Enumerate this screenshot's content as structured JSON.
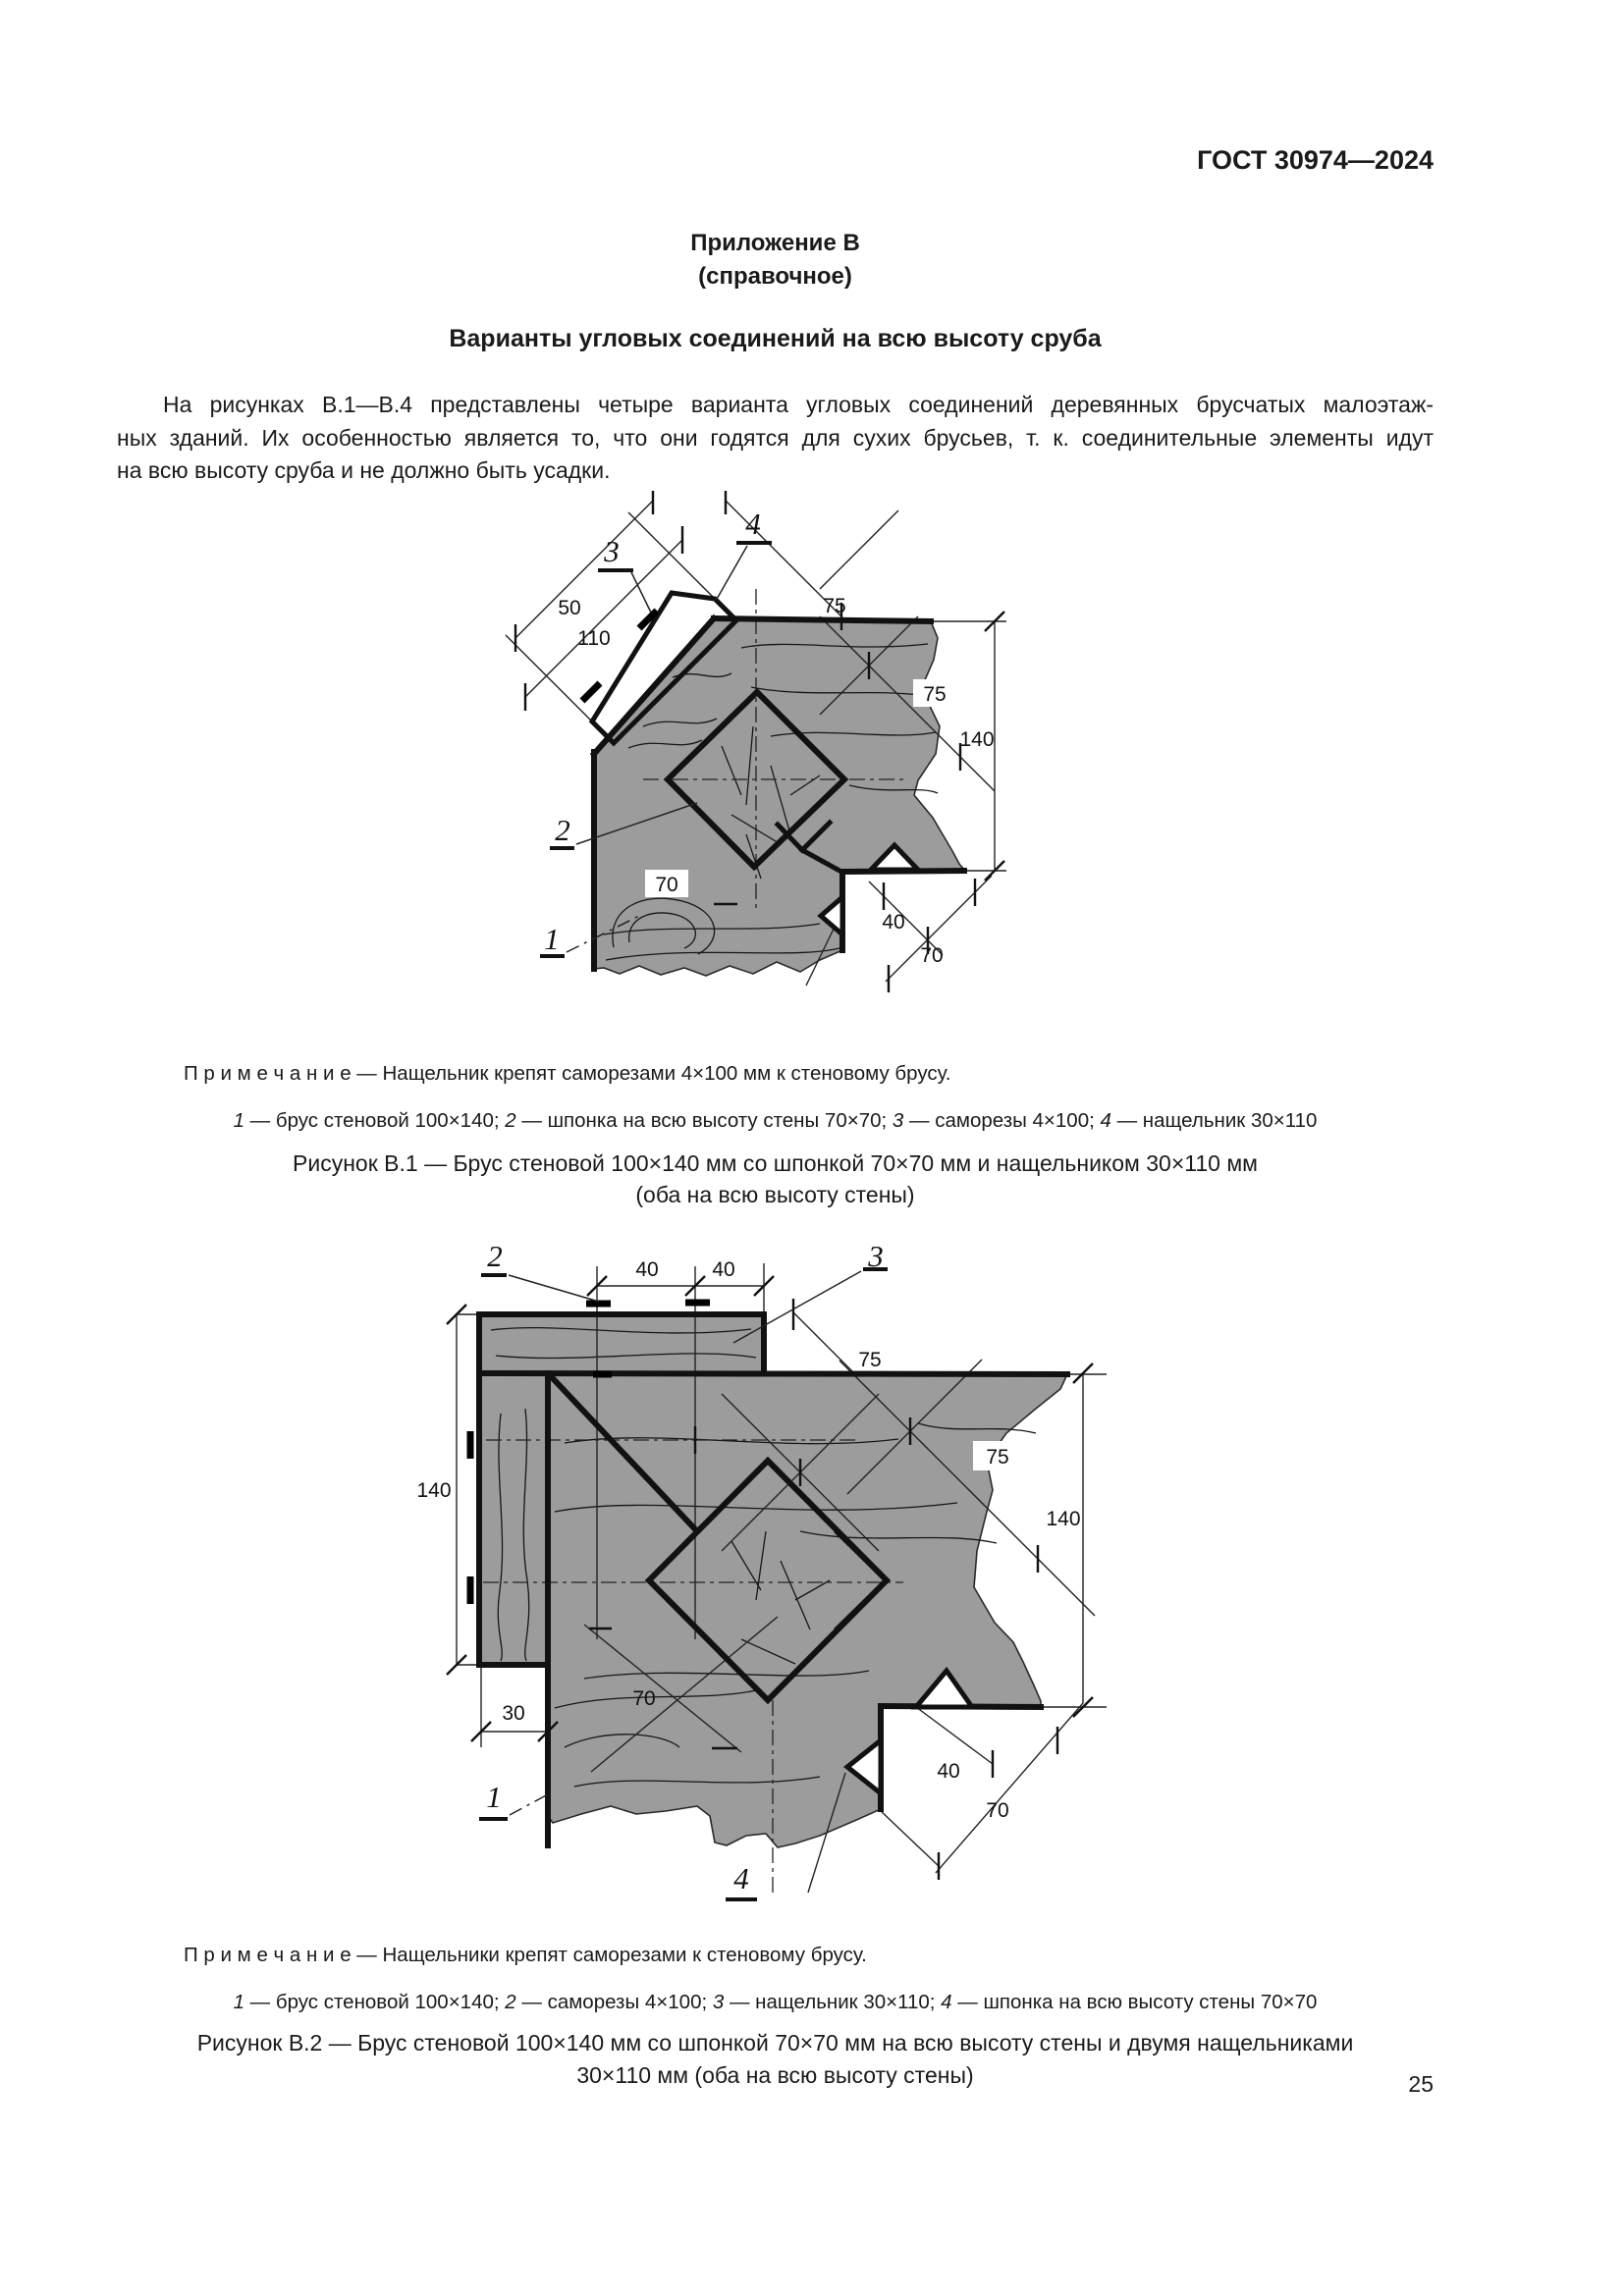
{
  "page": {
    "header": "ГОСТ 30974—2024",
    "number": "25"
  },
  "appendix": {
    "title": "Приложение В",
    "subtitle": "(справочное)",
    "heading": "Варианты угловых соединений на всю высоту сруба"
  },
  "intro": {
    "lines": [
      "На рисунках В.1—В.4 представлены четыре варианта угловых соединений деревянных брусчатых малоэтаж-",
      "ных зданий. Их особенностью является то, что они годятся для сухих брусьев, т. к. соединительные элементы идут",
      "на всю высоту сруба и не должно быть усадки."
    ]
  },
  "fig1": {
    "note": "П р и м е ч а н и е — Нащельник крепят саморезами 4×100 мм к стеновому брусу.",
    "legend": [
      {
        "num": "1",
        "text": " — брус стеновой 100×140; "
      },
      {
        "num": "2",
        "text": " — шпонка на всю высоту стены 70×70; "
      },
      {
        "num": "3",
        "text": " — саморезы 4×100; "
      },
      {
        "num": "4",
        "text": " — нащельник 30×110"
      }
    ],
    "caption_line1": "Рисунок В.1 — Брус стеновой 100×140 мм со шпонкой 70×70 мм и нащельником 30×110 мм",
    "caption_line2": "(оба на всю высоту стены)",
    "parts": {
      "p1": "1",
      "p2": "2",
      "p3": "3",
      "p4": "4"
    },
    "dims": {
      "d50": "50",
      "d110": "110",
      "d75_top": "75",
      "d75_right": "75",
      "d140": "140",
      "d70_key": "70",
      "d40": "40",
      "d70_corner": "70"
    }
  },
  "fig2": {
    "note": "П р и м е ч а н и е — Нащельники крепят саморезами к стеновому брусу.",
    "legend": [
      {
        "num": "1",
        "text": " — брус стеновой 100×140; "
      },
      {
        "num": "2",
        "text": " — саморезы 4×100; "
      },
      {
        "num": "3",
        "text": " — нащельник 30×110; "
      },
      {
        "num": "4",
        "text": " — шпонка на всю высоту стены 70×70"
      }
    ],
    "caption_line1": "Рисунок В.2 — Брус стеновой 100×140 мм со шпонкой 70×70 мм на всю высоту стены и двумя нащельниками",
    "caption_line2": "30×110 мм (оба на всю высоту стены)",
    "parts": {
      "p1": "1",
      "p2": "2",
      "p3": "3",
      "p4": "4"
    },
    "dims": {
      "d40_left": "40",
      "d40_right": "40",
      "d75_top": "75",
      "d140_left": "140",
      "d75_right": "75",
      "d140_right": "140",
      "d30": "30",
      "d70_key": "70",
      "d40_corner": "40",
      "d70_corner": "70"
    }
  }
}
